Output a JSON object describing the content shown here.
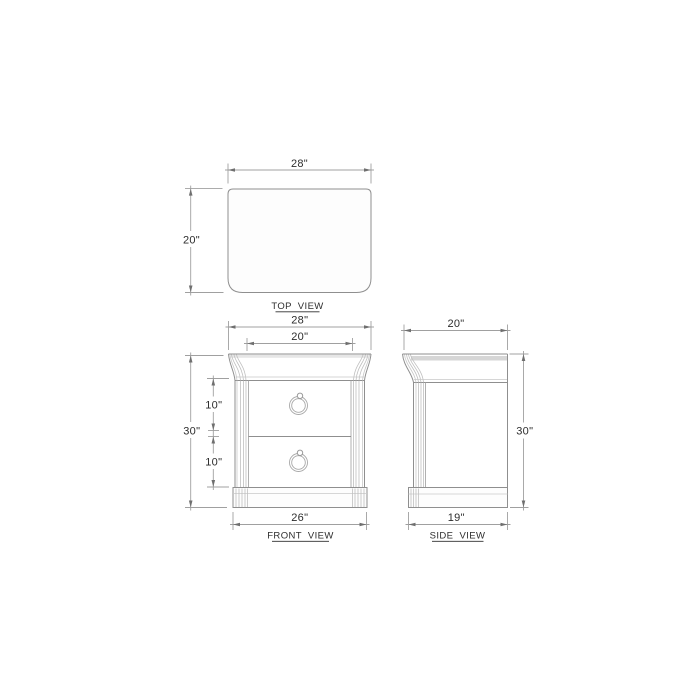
{
  "views": {
    "top": {
      "label": "TOP  VIEW",
      "width_dim": "28\"",
      "depth_dim": "20\""
    },
    "front": {
      "label": "FRONT  VIEW",
      "overall_width_dim": "28\"",
      "opening_width_dim": "20\"",
      "height_dim": "30\"",
      "upper_drawer_dim": "10\"",
      "lower_drawer_dim": "10\"",
      "base_width_dim": "26\""
    },
    "side": {
      "label": "SIDE  VIEW",
      "depth_dim": "20\"",
      "height_dim": "30\"",
      "base_depth_dim": "19\""
    }
  },
  "colors": {
    "background": "#ffffff",
    "line": "#8f8f8f",
    "line_light": "#c9c9c9",
    "line_flute": "#bfbfbf",
    "dim_line": "#a0a0a0",
    "tick": "#6f6f6f",
    "text": "#2d2d2d",
    "shade_front": "#e6e6e6",
    "shade_side": "#d6d6d6",
    "fill": "#fdfdfd"
  }
}
